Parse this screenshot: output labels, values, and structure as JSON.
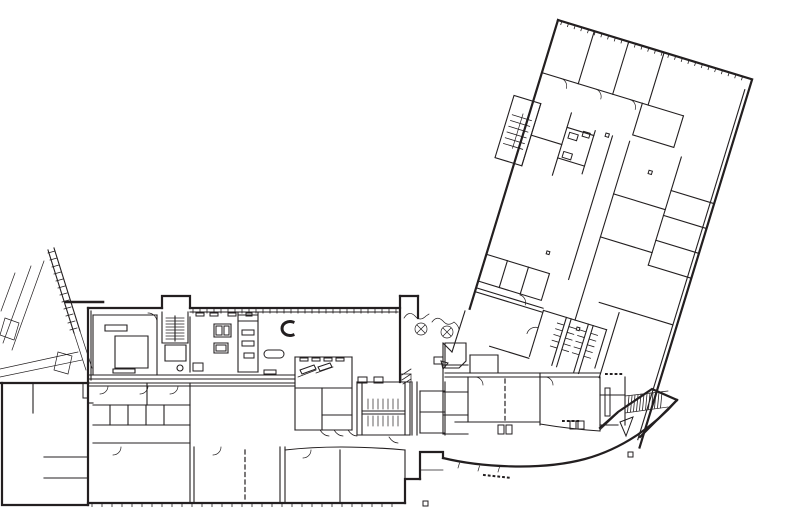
{
  "meta": {
    "title": "Architectural floor plan line drawing",
    "drawing_type": "building-floor-plan",
    "canvas": {
      "width": 793,
      "height": 523
    },
    "colors": {
      "paper": "#ffffff",
      "ink": "#231f20",
      "gray": "#808285"
    },
    "features": [
      "angled-classroom-wing",
      "main-horizontal-wing",
      "gymnasium-block",
      "curved-south-glass-wall",
      "entry-canopy",
      "restroom-cores",
      "stairs",
      "kitchen-serving-line",
      "library-with-table",
      "column-markers",
      "dashed-operable-partitions"
    ]
  },
  "drawing": {
    "viewBox": "0 0 793 523",
    "groups": [
      {
        "name": "angled-wing",
        "transform": "translate(558,20) rotate(17)",
        "ticks": [
          {
            "x": 4,
            "y": 0,
            "step": 7,
            "count": 28,
            "len": 4,
            "dir": "v"
          }
        ],
        "layers": {
          "outer": [
            "M0,0 H203 V385",
            "M0,0 V302"
          ],
          "inner": [
            "M199,12 V378",
            "M0,55 H148",
            "M38,0 V55",
            "M74,0 V55",
            "M111,0 V55",
            "M105,55 V88 H148 V55",
            "M158,130 H203",
            "M158,156 H203",
            "M158,182 H203",
            "M158,208 H203",
            "M158,130 V208",
            "M86,95 V245",
            "M104,95 V282",
            "M104,150 H158",
            "M104,195 H158",
            "M158,95 V130",
            "M0,245 H66 V273 H0",
            "M22,245 V273",
            "M44,245 V273",
            "M0,280 H70",
            "M0,284 H70",
            "M-20,85 H8 V150 H-20 Z",
            "M8,85 V150",
            "M8,118 H40",
            "M40,85 V150",
            "M40,100 H68",
            "M40,132 H68",
            "M68,95 V140",
            "M71,282 H137",
            "M71,282 V330",
            "M95,282 V332",
            "M100,282 V332",
            "M118,282 V332",
            "M123,282 V332",
            "M137,282 V322",
            "M30,332 H71",
            "M122,258 H199",
            "M144,262 V330"
          ],
          "fine": [
            "M20,55 a8,8 0 0 1 8,8",
            "M56,55 a8,8 0 0 1 8,8",
            "M92,55 a8,8 0 0 1 8,8",
            "M-6,100 V136",
            "M52,282 a8,8 0 0 0 -8,-8",
            "M71,300 a9,9 0 0 0 -9,9"
          ],
          "hatch": [
            "M-16,104 H4 M-16,110 H4 M-16,116 H4 M-16,122 H4 M-16,128 H4 M-16,134 H4",
            "M88,290 H95 M88,296 H95 M88,302 H95 M88,308 H95 M88,314 H95 M100,290 H107 M100,296 H107 M100,302 H107 M100,308 H107 M100,314 H107 M111,290 H118 M111,296 H118 M111,302 H118 M111,308 H118 M111,314 H118 M123,290 H130 M123,296 H130 M123,302 H130 M123,308 H130 M123,314 H130"
          ],
          "fills": [
            "M79,94 h3.5 v3.5 h-3.5 Z",
            "M131,117 h3.5 v3.5 h-3.5 Z",
            "M108,288 h3 v3 h-3 Z",
            "M57,224 h3 v3 h-3 Z",
            "M44,104 h9 v6 h-9 Z M44,124 h9 v6 h-9 Z M57,99 h7 v5 h-7 Z"
          ]
        }
      },
      {
        "name": "main-wing",
        "transform": "",
        "ticks": [
          {
            "x": 193,
            "y": 309,
            "step": 7,
            "count": 30,
            "len": 4.5,
            "dir": "v"
          },
          {
            "x": 92,
            "y": 503,
            "step": 10,
            "count": 31,
            "len": 4,
            "dir": "v"
          }
        ],
        "layers": {
          "outer": [
            "M0,383 H88",
            "M2,383 V505 H88",
            "M88,383 V505",
            "M88,503 H405",
            "M405,503 V479 H420",
            "M420,479 V452 H443 V458",
            "M443,458 C480,467 540,471 585,459 C625,448 656,424 677,400",
            "M88,308 H162",
            "M162,308 V296 H190 V308",
            "M190,308 H400",
            "M88,308 V383",
            "M400,296 V382",
            "M418,296 V318",
            "M400,296 H418",
            "M677,400 L652,389 L618,412 L600,428",
            "M677,400 L640,437"
          ],
          "inner": [
            "M91,311 V380",
            "M190,312 H398",
            "M88,375 H295",
            "M88,379 H295",
            "M93,315 V375",
            "M157,315 V375",
            "M93,315 H157",
            "M115,336 H148 V368 H115 Z",
            "M105,325 H127 V331 H105 Z",
            "M113,369 H135 V373 H113 Z",
            "M162,312 V343 H188",
            "M188,312 V343",
            "M165,345 H186 V361 H165 Z",
            "M175,316 V341",
            "M177,368 a3,3 0 1 0 6,0 a3,3 0 1 0 -6,0",
            "M190,317 V372",
            "M238,313 V372",
            "M258,313 V372",
            "M238,372 H258",
            "M214,324 h17 v13 h-17 Z",
            "M214,343 h14 v10 h-14 Z",
            "M295,357 V430",
            "M295,357 H352",
            "M352,357 V430",
            "M295,430 H352",
            "M295,388 H352",
            "M322,388 V430",
            "M322,415 H352",
            "M357,382 V435",
            "M362,382 V435",
            "M405,382 V435",
            "M410,382 V435",
            "M357,382 H410",
            "M357,435 H410",
            "M362,411 H405",
            "M362,414 H405",
            "M412,382 V435",
            "M417,382 V435",
            "M420,391 H445",
            "M420,412 H445",
            "M420,433 H445",
            "M445,382 V435",
            "M420,391 V433",
            "M445,343 H466 V361 L459,368 H445 Z",
            "M470,355 H498 V373",
            "M470,355 V373",
            "M445,373 H600",
            "M445,377 H600",
            "M468,377 V422",
            "M540,373 V425",
            "M455,422 H540",
            "M540,424 Q570,429 600,431",
            "M600,377 V430",
            "M600,395 H625",
            "M625,377 V425",
            "M600,425 H618",
            "M443,365 H468",
            "M443,392 H468",
            "M443,415 H468",
            "M443,434 H468",
            "M443,343 V434",
            "M93,405 H190",
            "M110,405 V425",
            "M128,405 V425",
            "M146,405 V425",
            "M164,405 V425",
            "M93,425 H190",
            "M147,383 V405",
            "M93,443 H190",
            "M190,383 V503",
            "M194,447 V503",
            "M280,447 V503",
            "M285,447 V503",
            "M285,450 C320,446 360,446 405,450",
            "M340,450 V503",
            "M405,450 V479",
            "M88,383 H295",
            "M88,386 H295",
            "M48,250 L74,333",
            "M54,248 L80,331",
            "M465,311 L452,352",
            "M452,352 L443,343"
          ],
          "fine": [
            "M148,313 a9,9 0 0 1 9,9",
            "M108,386 a8,8 0 0 1 -8,8 M148,386 a8,8 0 0 1 -8,8 M178,386 a8,8 0 0 1 -8,8",
            "M121,447 a8,8 0 0 1 -8,8 M221,447 a8,8 0 0 1 -8,8 M311,450 a8,8 0 0 1 -8,8",
            "M320,430 q4,6 9,6 M334,430 q4,6 9,6 M348,430 q4,6 9,6 M389,437 q4,6 9,6",
            "M404,318 q5,-8 11,-2 q5,6 11,0 l3,-2",
            "M432,322 q5,-7 11,-1 q5,6 11,1 q4,3 5,7",
            "M415,329 a6,6 0 1 0 12,0 a6,6 0 1 0 -12,0 M417,325 l8,8 M417,333 l8,-8",
            "M441,332 a6,6 0 1 0 12,0 a6,6 0 1 0 -12,0 M443,328 l8,8 M443,336 l8,-8",
            "M368,399 V409 M373,399 V409 M378,399 V409 M383,399 V409 M388,399 V409 M393,399 V409 M398,399 V409",
            "M368,416 V426 M373,416 V426 M378,416 V426 M383,416 V426 M388,416 V426 M393,416 V426 M398,416 V426",
            "M298,377 l18,-7 M316,373 l17,-6",
            "M44,261 L12,350 M31,266 L3,343 M15,273 L1,311",
            "M0,369 L78,352 M0,377 L82,360",
            "M5,318 L19,323 L14,340 L0,335 Z",
            "M58,352 L72,356 L68,374 L54,370 Z",
            "M74,333 L86,370 M80,331 L92,368",
            "M458,468 l1.5,-5 M478,471 l1.5,-5 M498,472 l1.5,-5",
            "M420,470 H443",
            "M600,430 L618,413",
            "M625,396 L668,391 M625,413 L668,407",
            "M401,374 h10 v8 h-10 Z",
            "M475,377 a8,8 0 0 1 8,8 M545,377 a8,8 0 0 1 8,8"
          ],
          "thick": [
            "M293,322 a8,7 0 1 0 0,13"
          ],
          "hatch": [
            "M48,253 l7,-2 M50,260 l7,-2 M52,267 l7,-2 M54,274 l7,-2 M56,281 l7,-2 M58,288 l7,-2 M60,295 l7,-2 M62,302 l7,-2 M64,309 l7,-2 M66,316 l7,-2 M68,323 l7,-2 M70,330 l7,-2",
            "M166,318 H184 M166,321 H184 M166,324 H184 M166,327 H184 M166,330 H184 M166,333 H184 M166,336 H184 M166,339 H184",
            "M629,396 l-1.5,16 M632,396 l-1.5,16 M635,395 l-1.5,16 M638,395 l-1.5,16 M641,394 l-1.5,16 M644,394 l-1.5,16 M647,394 l-1.5,16 M650,393 l-1.5,16 M653,393 l-1.5,16 M656,392 l-1.5,16 M659,392 l-1.5,16 M662,392 l-1.5,16",
            "M402,375 l9,-6 M402,380 l9,-6 M403,384 l8,-5"
          ],
          "fills": [
            "M216,326 h6 v9 h-6 Z M224,326 h5 v9 h-5 Z M216,345 h10 v6 h-10 Z M193,363 h10 v8 h-10 Z",
            "M238,315 h20 v6 h-20 Z M242,330 h12 v5 h-12 Z M242,341 h12 v5 h-12 Z M244,353 h10 v5 h-10 Z",
            "M268,350 h12 a4,4 0 0 1 0,8 h-12 a4,4 0 0 1 0,-8 Z",
            "M264,370 h12 v4 h-12 Z",
            "M196,313 h8 v3 h-8 Z M210,313 h8 v3 h-8 Z M228,313 h8 v3 h-8 Z M246,313 h6 v3 h-6 Z",
            "M300,370 l14,-5 l2,4 l-14,5 Z M318,367 l12,-4 l2,4 l-12,4 Z",
            "M300,358 h8 v3 h-8 Z M312,358 h8 v3 h-8 Z M324,358 h8 v3 h-8 Z M336,358 h8 v3 h-8 Z",
            "M358,377 h9 v6 h-9 Z M374,377 h9 v6 h-9 Z",
            "M434,357 h9 v7 h-9 Z",
            "M441,361 l7,2 l-5,6 Z",
            "M498,425 h6 v9 h-6 Z M506,425 h6 v9 h-6 Z M570,421 h6 v8 h-6 Z M578,421 h6 v8 h-6 Z",
            "M605,388 h5 v28 h-5 Z",
            "M83,383 h5 v15 h-5 Z",
            "M423,501 h5 v5 h-5 Z M628,452 h5 v5 h-5 Z",
            "M620,422 l13,-5 l-7,19 Z"
          ],
          "dashed": [
            "M245,450 V500",
            "M505,379 V420"
          ],
          "dotted": [
            "M606,374 H625",
            "M563,421 H580",
            "M484,475 L512,478"
          ],
          "gray": [
            "M66,302 H103"
          ]
        }
      },
      {
        "name": "gym-interior",
        "transform": "",
        "ticks": [],
        "layers": {
          "inner": [
            "M44,457 H88",
            "M44,478 H88",
            "M33,383 V413",
            "M88,403 H93"
          ]
        }
      }
    ]
  }
}
